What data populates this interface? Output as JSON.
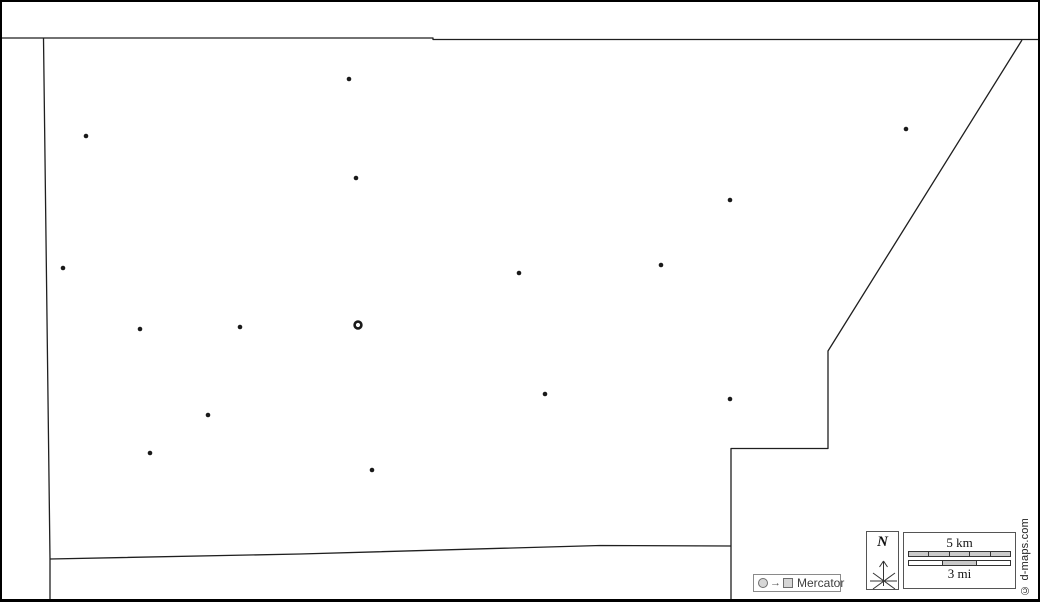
{
  "map": {
    "background_color": "#ffffff",
    "line_color": "#1f1f1f",
    "marker_color": "#1a1a1a",
    "outline_paths": [
      "M 0 38 L 433 38 L 433 39.5 L 1038 39.5",
      "M 43.5 38 L 50 559 L 50 600",
      "M 50 559 L 300 554 L 600 545.5 L 731 546",
      "M 1022 40 L 828 351 L 828 448.5 L 731 448.5 L 731 600"
    ],
    "towns": [
      {
        "x": 349,
        "y": 79
      },
      {
        "x": 86,
        "y": 136
      },
      {
        "x": 356,
        "y": 178
      },
      {
        "x": 906,
        "y": 129
      },
      {
        "x": 730,
        "y": 200
      },
      {
        "x": 63,
        "y": 268
      },
      {
        "x": 519,
        "y": 273
      },
      {
        "x": 661,
        "y": 265
      },
      {
        "x": 140,
        "y": 329
      },
      {
        "x": 240,
        "y": 327
      },
      {
        "x": 545,
        "y": 394
      },
      {
        "x": 730,
        "y": 399
      },
      {
        "x": 208,
        "y": 415
      },
      {
        "x": 150,
        "y": 453
      },
      {
        "x": 372,
        "y": 470
      }
    ],
    "town_radius": 2.3,
    "capital": {
      "x": 358,
      "y": 325,
      "radius": 3.4
    }
  },
  "north_box": {
    "label": "N"
  },
  "scale_box": {
    "km_label": "5 km",
    "mi_label": "3 mi",
    "km_fills": [
      "g",
      "g",
      "g",
      "g",
      "g"
    ],
    "mi_fills": [
      "w",
      "g",
      "w"
    ]
  },
  "projection_legend": {
    "label": "Mercator",
    "arrow": "→"
  },
  "copyright": "© d-maps.com"
}
